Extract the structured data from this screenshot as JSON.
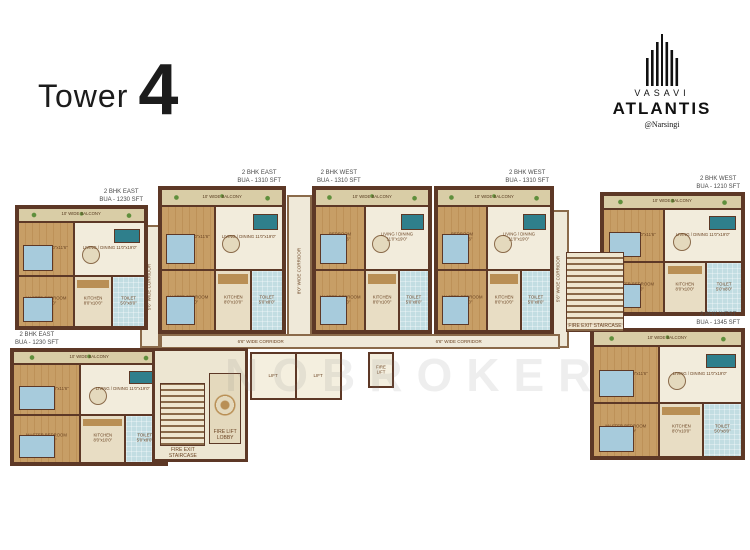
{
  "header": {
    "title_prefix": "Tower",
    "title_number": "4",
    "brand": {
      "logo_icon": "building-bars-icon",
      "name_top": "VASAVI",
      "name_main": "ATLANTIS",
      "location": "@Narsingi"
    }
  },
  "watermark": "NOBROKER",
  "colors": {
    "wall": "#5d3826",
    "floor_cream": "#ede6d2",
    "floor_wood": "#c79e66",
    "toilet_blue": "#c2dde2",
    "balcony_plant_green": "#5f8f3c",
    "accent_teal": "#2f7f8c",
    "label_brown": "#6b4423",
    "title_black": "#1c1c1c"
  },
  "plan": {
    "room_template": [
      {
        "name": "10' WIDE BALCONY",
        "kind": "balcony",
        "w": 100,
        "h": 12
      },
      {
        "name": "BEDROOM 10'0\"x11'6\"",
        "kind": "bed",
        "w": 44,
        "h": 45
      },
      {
        "name": "LIVING / DINING 11'0\"x19'0\"",
        "kind": "living",
        "w": 56,
        "h": 45
      },
      {
        "name": "MASTER BEDROOM 11'0\"x12'0\"",
        "kind": "bed",
        "w": 44,
        "h": 43
      },
      {
        "name": "KITCHEN 8'0\"x10'0\"",
        "kind": "kitchen",
        "w": 30,
        "h": 43
      },
      {
        "name": "TOILET 5'0\"x8'0\"",
        "kind": "toilet",
        "w": 26,
        "h": 43
      }
    ],
    "units": [
      {
        "type": "2 BHK EAST",
        "area": "BUA - 1230 SFT",
        "x": 15,
        "y": 205,
        "w": 133,
        "h": 125,
        "label_align": "right"
      },
      {
        "type": "2 BHK EAST",
        "area": "BUA - 1310 SFT",
        "x": 158,
        "y": 186,
        "w": 128,
        "h": 148,
        "label_align": "right"
      },
      {
        "type": "2 BHK WEST",
        "area": "BUA - 1310 SFT",
        "x": 312,
        "y": 186,
        "w": 120,
        "h": 148,
        "label_align": "left"
      },
      {
        "type": "2 BHK WEST",
        "area": "BUA - 1310 SFT",
        "x": 434,
        "y": 186,
        "w": 120,
        "h": 148,
        "label_align": "right"
      },
      {
        "type": "2 BHK WEST",
        "area": "BUA - 1210 SFT",
        "x": 600,
        "y": 192,
        "w": 145,
        "h": 124,
        "label_align": "right"
      },
      {
        "type": "2 BHK EAST",
        "area": "BUA - 1230 SFT",
        "x": 10,
        "y": 348,
        "w": 158,
        "h": 118,
        "label_align": "left"
      },
      {
        "type": "2 BHK WEST",
        "area": "BUA - 1345 SFT",
        "x": 590,
        "y": 328,
        "w": 155,
        "h": 132,
        "label_align": "right"
      }
    ],
    "corridors": [
      {
        "label": "5'6\" WIDE CORRIDOR",
        "orientation": "vertical",
        "x": 140,
        "y": 225,
        "w": 20,
        "h": 123
      },
      {
        "label": "8'0\" WIDE CORRIDOR",
        "orientation": "vertical",
        "x": 287,
        "y": 195,
        "w": 25,
        "h": 152
      },
      {
        "label": "5'6\" WIDE CORRIDOR",
        "orientation": "vertical",
        "x": 549,
        "y": 210,
        "w": 20,
        "h": 138
      },
      {
        "label": "6'6\" WIDE CORRIDOR",
        "orientation": "horizontal",
        "x": 160,
        "y": 334,
        "w": 400,
        "h": 15
      }
    ],
    "core": {
      "fire_exit_staircase": "FIRE EXIT STAIRCASE",
      "fire_lift_lobby": "FIRE LIFT LOBBY",
      "lifts": [
        "LIFT",
        "LIFT"
      ],
      "fire_lift": "FIRE LIFT",
      "right_staircase": "FIRE EXIT STAIRCASE"
    }
  }
}
